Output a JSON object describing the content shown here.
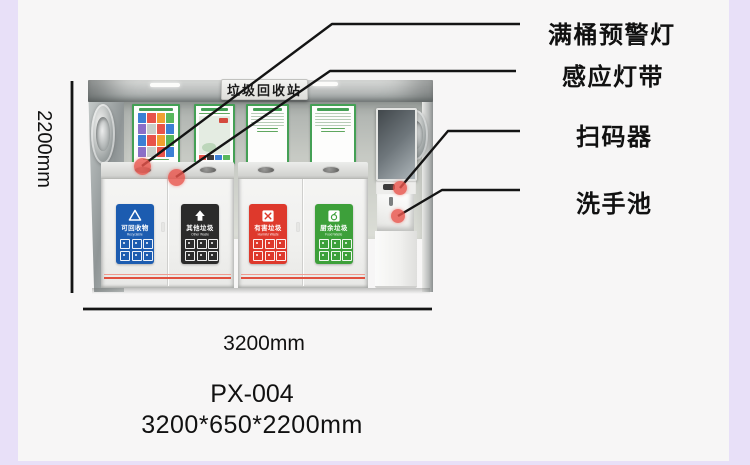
{
  "page": {
    "background_color": "#e8e0f8",
    "card_color": "#f7f6f6"
  },
  "station": {
    "sign": "垃圾回收站",
    "bins": [
      {
        "name": "可回收物",
        "name_en": "Recyclable",
        "color": "#1c5cb0"
      },
      {
        "name": "其他垃圾",
        "name_en": "Other Waste",
        "color": "#2b2b2b"
      },
      {
        "name": "有害垃圾",
        "name_en": "Harmful Waste",
        "color": "#de392c"
      },
      {
        "name": "厨余垃圾",
        "name_en": "Food Waste",
        "color": "#3da03a"
      }
    ]
  },
  "callouts": [
    {
      "label": "满桶预警灯"
    },
    {
      "label": "感应灯带"
    },
    {
      "label": "扫码器"
    },
    {
      "label": "洗手池"
    }
  ],
  "dimensions": {
    "height": "2200mm",
    "width": "3200mm"
  },
  "product": {
    "model": "PX-004",
    "size": "3200*650*2200mm"
  },
  "colors": {
    "callout_dot": "#e9564d",
    "annotation_line": "#141414"
  }
}
